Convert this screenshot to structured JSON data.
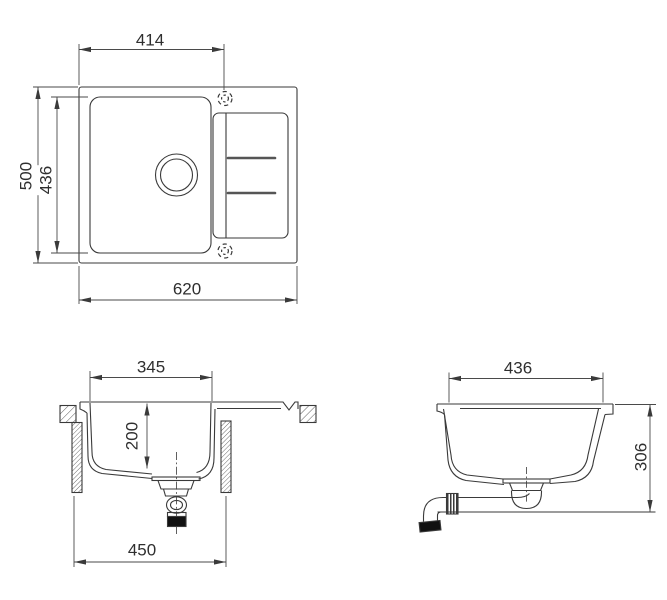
{
  "drawing": {
    "colors": {
      "line": "#3a3a3a",
      "dim_line": "#4a4a4a",
      "text": "#2f2f2f"
    },
    "top_view": {
      "overall_width": "620",
      "overall_depth": "500",
      "bowl_cutout_depth": "436",
      "tap_hole_offset": "414"
    },
    "front_section": {
      "bowl_top_width": "345",
      "bowl_depth": "200",
      "cabinet_width": "450"
    },
    "side_section": {
      "bowl_top_length": "436",
      "installation_height": "306"
    }
  }
}
